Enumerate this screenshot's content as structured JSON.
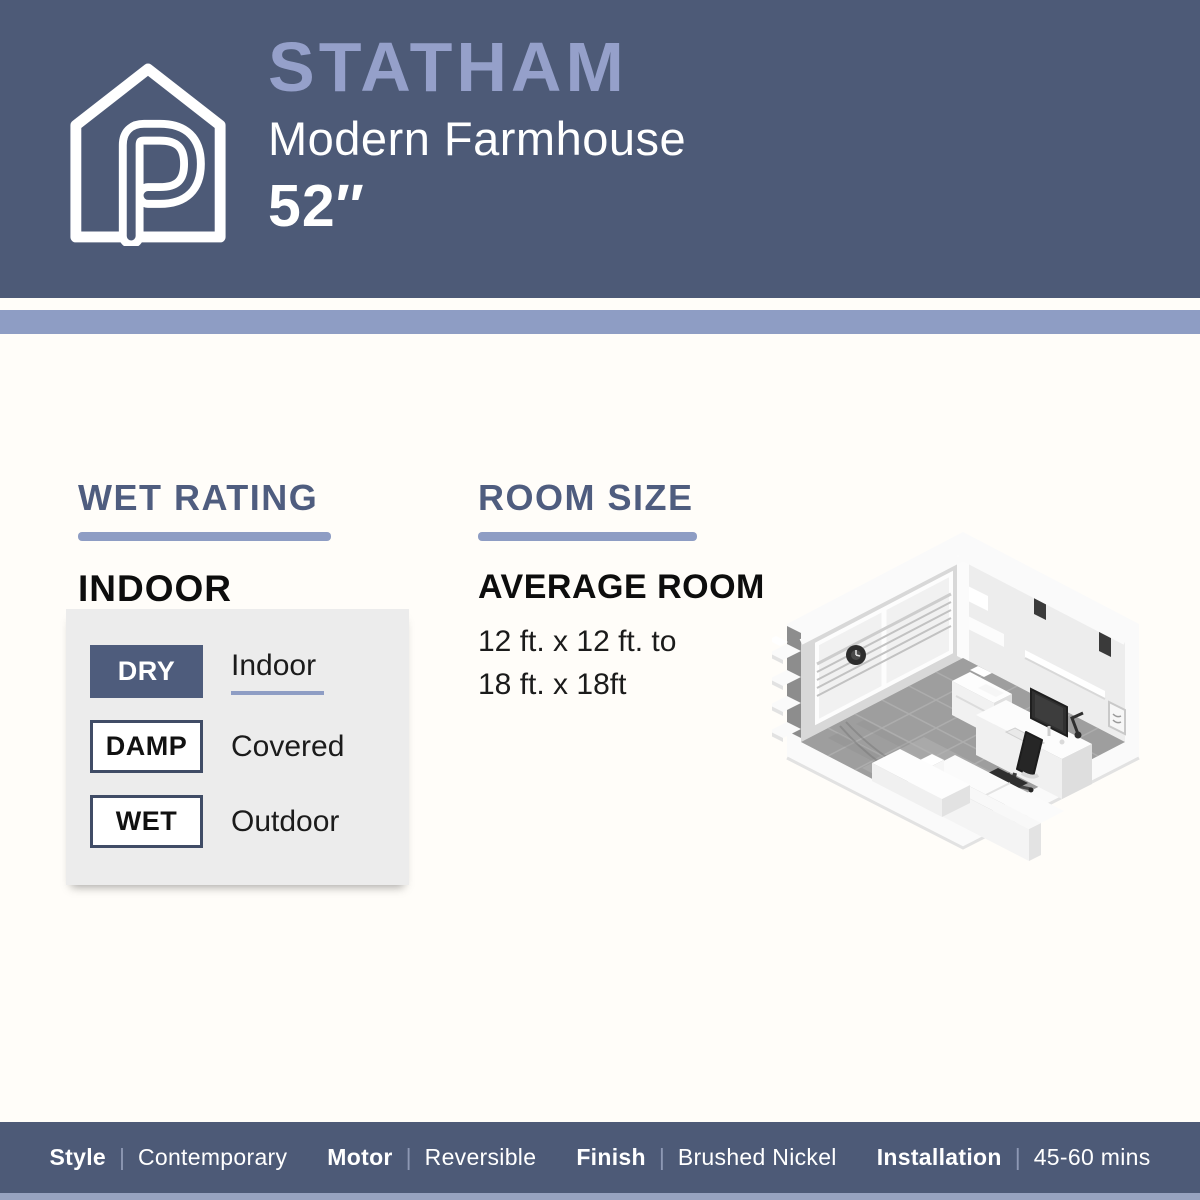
{
  "header": {
    "title": "STATHAM",
    "subtitle": "Modern Farmhouse",
    "size": "52″",
    "logo_icon": "house-p-logo"
  },
  "wet_rating": {
    "heading": "WET RATING",
    "rating": "INDOOR",
    "rows": [
      {
        "badge": "DRY",
        "label": "Indoor",
        "active": true
      },
      {
        "badge": "DAMP",
        "label": "Covered",
        "active": false
      },
      {
        "badge": "WET",
        "label": "Outdoor",
        "active": false
      }
    ]
  },
  "room_size": {
    "heading": "ROOM SIZE",
    "subheading": "AVERAGE ROOM",
    "range_line1": "12 ft. x 12 ft. to",
    "range_line2": "18 ft. x 18ft",
    "illustration": "isometric-room-illustration"
  },
  "footer": {
    "divider": "|",
    "specs": [
      {
        "label": "Style",
        "value": "Contemporary"
      },
      {
        "label": "Motor",
        "value": "Reversible"
      },
      {
        "label": "Finish",
        "value": "Brushed Nickel"
      },
      {
        "label": "Installation",
        "value": "45-60 mins"
      }
    ]
  },
  "colors": {
    "header_bg": "#4d5a77",
    "accent_stripe": "#8e9dc4",
    "title_text": "#95a0ca",
    "heading_text": "#4f5d7f",
    "dry_badge_bg": "#4e5c7c",
    "body_bg": "#fffdf9"
  }
}
